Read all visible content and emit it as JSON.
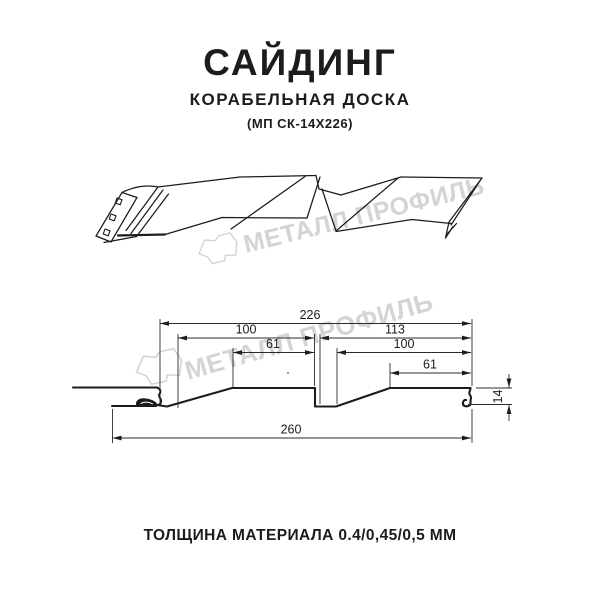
{
  "header": {
    "title": "САЙДИНГ",
    "subtitle": "КОРАБЕЛЬНАЯ ДОСКА",
    "model_code": "(МП СК-14Х226)"
  },
  "watermark": {
    "text": "МЕТАЛЛ ПРОФИЛЬ",
    "color": "#d4d4d4"
  },
  "cross_section": {
    "dims": {
      "top_total": "226",
      "left_width": "100",
      "left_face": "61",
      "right_total": "113",
      "right_width": "100",
      "right_face": "61",
      "height": "14",
      "bottom_total": "260"
    }
  },
  "footer": {
    "thickness_label": "ТОЛЩИНА МАТЕРИАЛА 0.4/0,45/0,5 ММ"
  },
  "colors": {
    "line": "#1c1c1c",
    "dim_line": "#2b2b2b",
    "watermark": "#d4d4d4",
    "background": "#ffffff"
  }
}
